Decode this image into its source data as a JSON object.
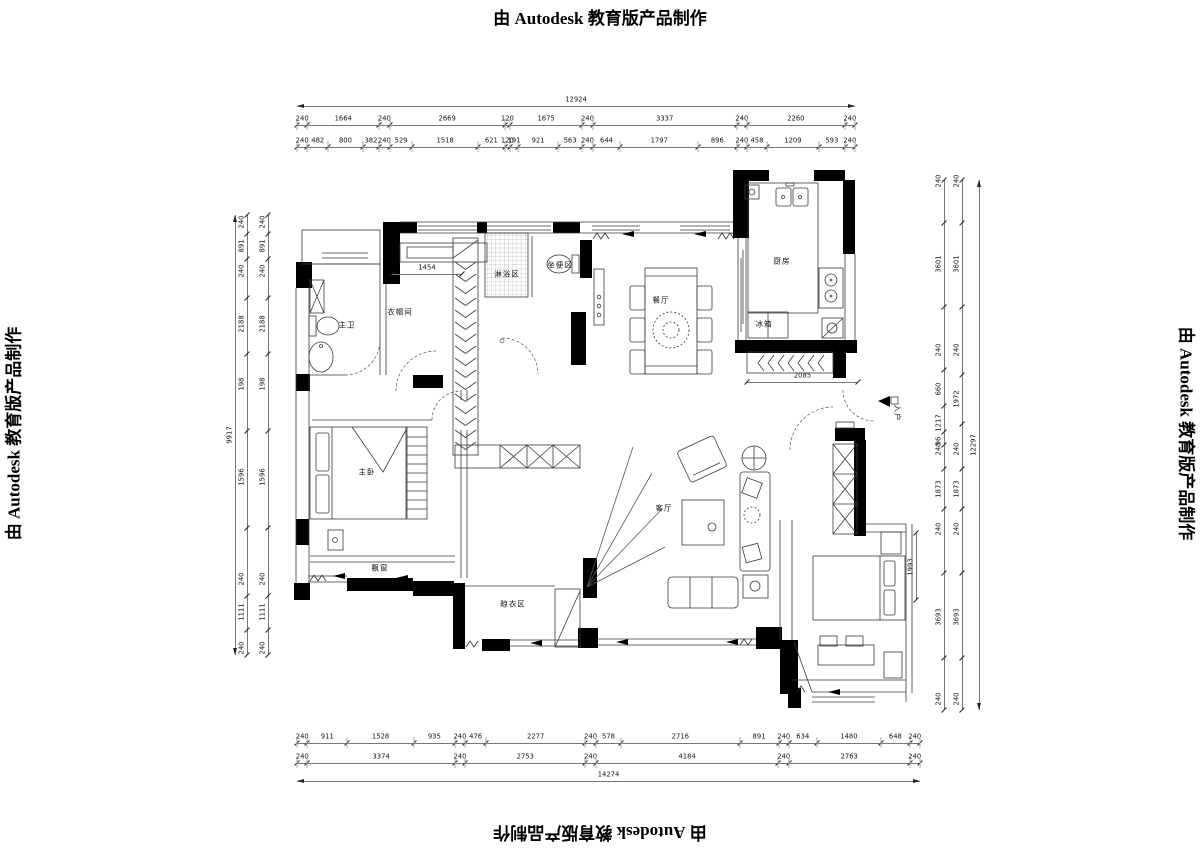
{
  "watermark": {
    "text": "由 Autodesk 教育版产品制作"
  },
  "plan": {
    "room_labels": [
      {
        "t": "主卫",
        "x": 347,
        "y": 325
      },
      {
        "t": "衣帽间",
        "x": 400,
        "y": 312
      },
      {
        "t": "淋浴区",
        "x": 507,
        "y": 274
      },
      {
        "t": "坐便区",
        "x": 560,
        "y": 265
      },
      {
        "t": "餐厅",
        "x": 661,
        "y": 300
      },
      {
        "t": "厨房",
        "x": 782,
        "y": 261
      },
      {
        "t": "冰箱",
        "x": 764,
        "y": 324
      },
      {
        "t": "入户",
        "x": 897,
        "y": 413,
        "rot": 90
      },
      {
        "t": "主卧",
        "x": 367,
        "y": 472
      },
      {
        "t": "飘窗",
        "x": 380,
        "y": 568
      },
      {
        "t": "客厅",
        "x": 664,
        "y": 508
      },
      {
        "t": "晾衣区",
        "x": 513,
        "y": 604
      }
    ]
  },
  "dims": {
    "h_chains": [
      {
        "x0": 297,
        "x1": 855,
        "y": 119,
        "values": [
          240,
          1664,
          240,
          2669,
          120,
          1675,
          240,
          3337,
          240,
          2260,
          240
        ]
      },
      {
        "x0": 297,
        "x1": 855,
        "y": 141,
        "values": [
          240,
          482,
          800,
          382,
          240,
          529,
          1518,
          621,
          120,
          191,
          921,
          563,
          240,
          644,
          1797,
          896,
          240,
          458,
          1209,
          593,
          240
        ]
      },
      {
        "x0": 297,
        "x1": 920,
        "y": 737,
        "values": [
          240,
          911,
          1528,
          935,
          240,
          476,
          2277,
          240,
          578,
          2716,
          891,
          240,
          634,
          1480,
          648,
          240
        ]
      },
      {
        "x0": 297,
        "x1": 920,
        "y": 757,
        "values": [
          240,
          3374,
          240,
          2753,
          240,
          4184,
          240,
          2763,
          240
        ]
      }
    ],
    "v_chains": [
      {
        "x": 242,
        "y1": 215,
        "y2": 655,
        "labels": [
          [
            "240",
            222
          ],
          [
            "891",
            246
          ],
          [
            "240",
            271
          ],
          [
            "2188",
            324
          ],
          [
            "198",
            384
          ],
          [
            "1596",
            477
          ],
          [
            "240",
            579
          ],
          [
            "1111",
            612
          ],
          [
            "240",
            648
          ]
        ]
      },
      {
        "x": 263,
        "y1": 215,
        "y2": 655,
        "labels": [
          [
            "240",
            222
          ],
          [
            "891",
            246
          ],
          [
            "240",
            271
          ],
          [
            "2188",
            324
          ],
          [
            "198",
            384
          ],
          [
            "1596",
            477
          ],
          [
            "240",
            579
          ],
          [
            "1111",
            612
          ],
          [
            "240",
            648
          ]
        ]
      },
      {
        "x": 939,
        "y1": 180,
        "y2": 710,
        "labels": [
          [
            "240",
            181
          ],
          [
            "3601",
            264
          ],
          [
            "240",
            350
          ],
          [
            "660",
            389
          ],
          [
            "1217",
            423
          ],
          [
            "96",
            441
          ],
          [
            "240",
            449
          ],
          [
            "1873",
            489
          ],
          [
            "240",
            529
          ],
          [
            "3693",
            617
          ],
          [
            "240",
            699
          ]
        ]
      },
      {
        "x": 957,
        "y1": 180,
        "y2": 710,
        "labels": [
          [
            "240",
            181
          ],
          [
            "3601",
            264
          ],
          [
            "240",
            350
          ],
          [
            "1972",
            399
          ],
          [
            "240",
            449
          ],
          [
            "1873",
            489
          ],
          [
            "240",
            529
          ],
          [
            "3693",
            617
          ],
          [
            "240",
            699
          ]
        ]
      }
    ],
    "overall": [
      {
        "t": "12924",
        "dir": "h",
        "x1": 297,
        "x2": 855,
        "y": 100
      },
      {
        "t": "14274",
        "dir": "h",
        "x1": 297,
        "x2": 920,
        "y": 775
      },
      {
        "t": "9917",
        "dir": "v",
        "x": 230,
        "y1": 215,
        "y2": 655
      },
      {
        "t": "12297",
        "dir": "v",
        "x": 974,
        "y1": 180,
        "y2": 710
      }
    ],
    "inner": [
      {
        "t": "1454",
        "dir": "h",
        "x1": 392,
        "x2": 462,
        "y": 268
      },
      {
        "t": "2085",
        "dir": "h",
        "x1": 747,
        "x2": 858,
        "y": 376
      },
      {
        "t": "1993",
        "dir": "v",
        "x": 911,
        "y1": 533,
        "y2": 600
      }
    ]
  }
}
